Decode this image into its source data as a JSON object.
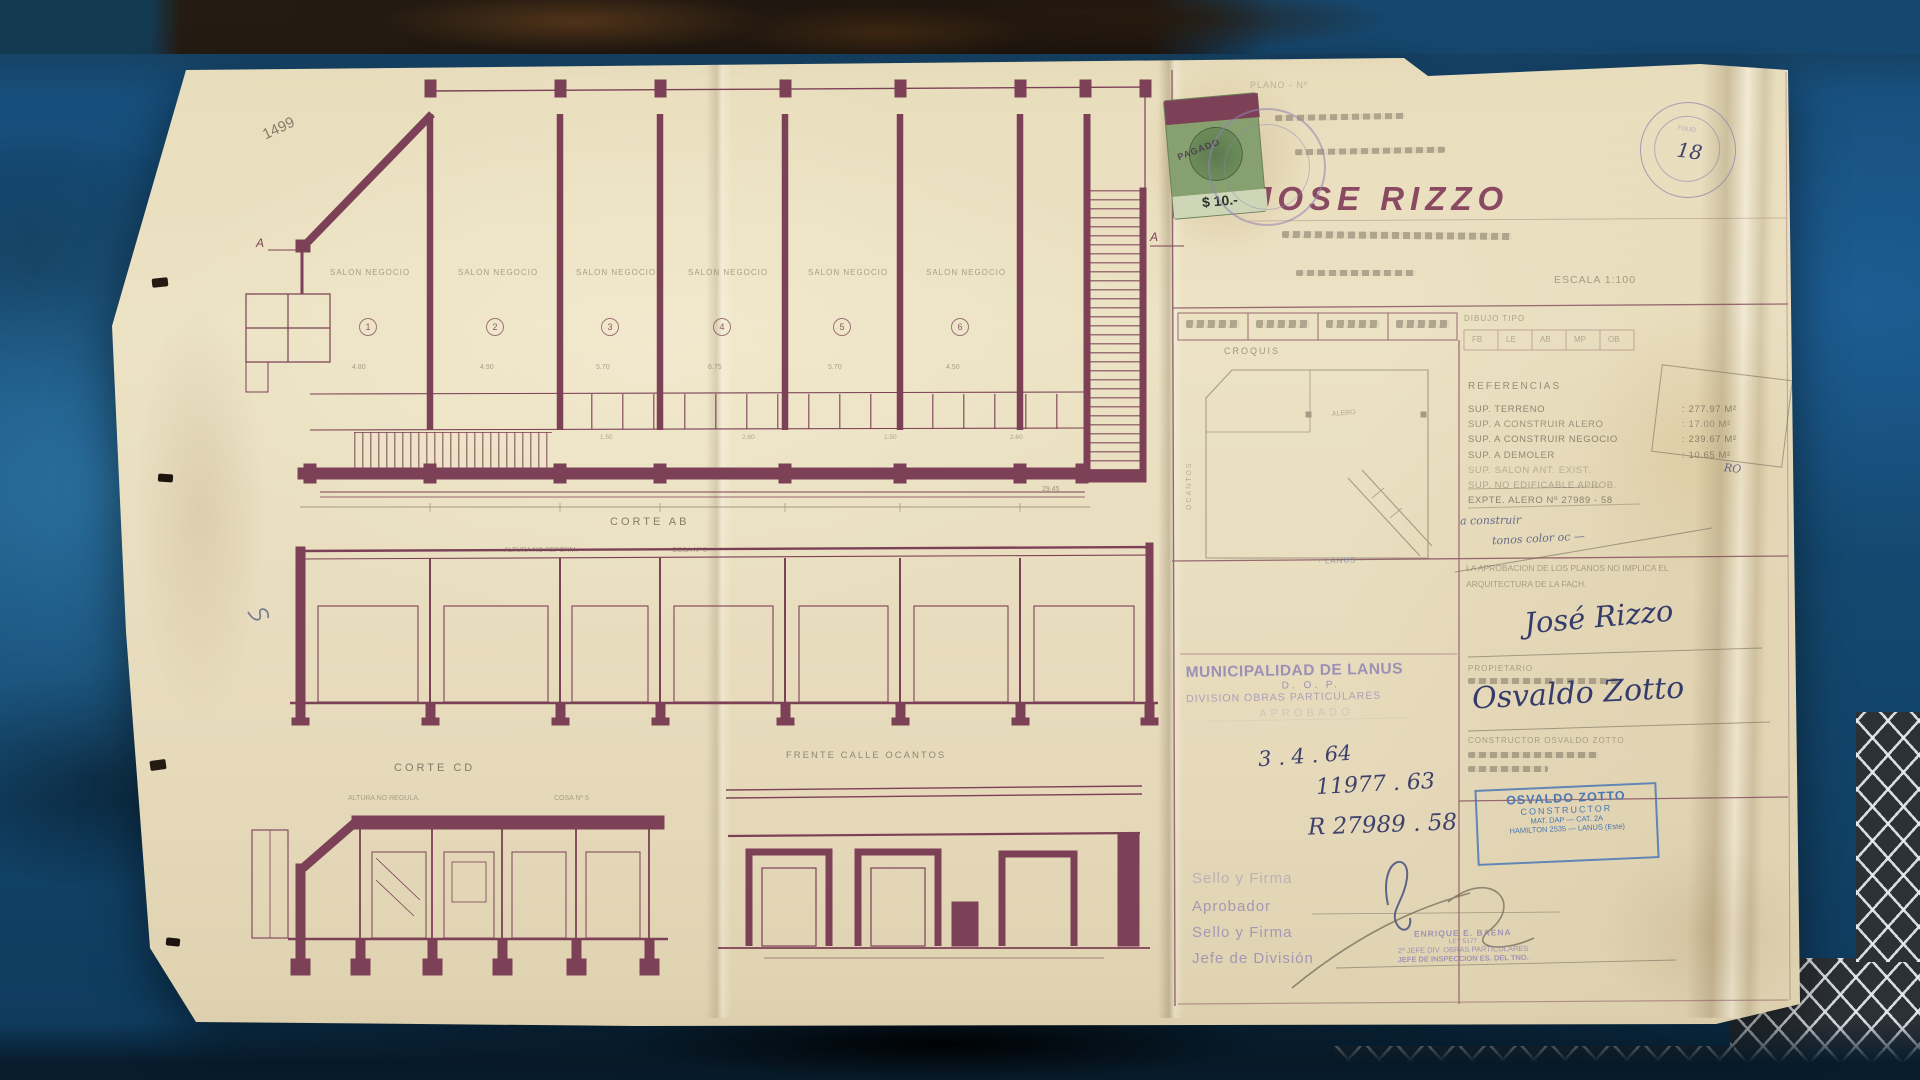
{
  "colors": {
    "paper": "#e9dec0",
    "ink_maroon": "#7c4156",
    "pencil_gray": "#6e6354",
    "stamp_purple": "#8f84b4",
    "stamp_blue": "#4a77b4",
    "ink_blue": "#3c477c",
    "table_blue": "#1b5484",
    "fiscal_green": "#86a070"
  },
  "plan": {
    "sheet_number": "1499",
    "section_marker": "A",
    "salon_label": "SALON NEGOCIO",
    "bay_numbers": [
      "1",
      "2",
      "3",
      "4",
      "5",
      "6"
    ],
    "bay_dims": [
      "4.80",
      "4.90",
      "5.70",
      "6.75",
      "5.70",
      "4.50"
    ],
    "service_dims": [
      "1.50",
      "2.60",
      "1.50",
      "2.60"
    ],
    "total_dim": "29.45",
    "corte_ab_label": "CORTE AB",
    "corte_ab_note_left": "ALTURA NO REFORM.",
    "corte_ab_note_right": "COSA Nº 5",
    "corte_cd_label": "CORTE CD",
    "corte_cd_note_left": "ALTURA NO REGULA.",
    "corte_cd_note_right": "COSA Nº 5",
    "frente_label": "FRENTE CALLE OCANTOS"
  },
  "title_block": {
    "top_pencil_line": "PLANO - Nº",
    "owner_name": "JOSE RIZZO",
    "escala": "ESCALA 1:100",
    "dibujo_tipo_label": "DIBUJO TIPO",
    "dibujo_cells": [
      "FB",
      "LE",
      "AB",
      "MP",
      "OB"
    ],
    "croquis_label": "CROQUIS",
    "croquis_street": "OCANTOS",
    "croquis_alero": "ALERO",
    "croquis_fragment": "· LANUS ·",
    "referencias_title": "REFERENCIAS",
    "ref_rows": [
      {
        "label": "SUP. TERRENO",
        "value": ": 277.97 M²"
      },
      {
        "label": "SUP. A CONSTRUIR ALERO",
        "value": ": 17.00 M²"
      },
      {
        "label": "SUP. A CONSTRUIR NEGOCIO",
        "value": ": 239.67 M²"
      },
      {
        "label": "SUP. A DEMOLER",
        "value": ": 10.65 M²"
      },
      {
        "label": "SUP. SALON ANT. EXIST.",
        "value": ""
      },
      {
        "label": "SUP. NO EDIFICABLE APROB.",
        "value": ""
      },
      {
        "label": "EXPTE. ALERO Nº 27989 - 58",
        "value": ""
      }
    ],
    "blue_note_1": "a construir",
    "blue_note_2": "tonos color  oc —",
    "blue_note_3": "RO",
    "aprobacion_line_1": "LA APROBACION DE LOS PLANOS NO IMPLICA EL",
    "aprobacion_line_2": "ARQUITECTURA DE LA FACH.",
    "owner_signature": "José Rizzo",
    "propietario_label": "PROPIETARIO",
    "builder_signature": "Osvaldo Zotto",
    "constructor_label": "CONSTRUCTOR  OSVALDO ZOTTO",
    "zotto_stamp": {
      "line1": "OSVALDO ZOTTO",
      "line2": "CONSTRUCTOR",
      "line3": "MAT. DAP — CAT. 2A",
      "line4": "HAMILTON 2535 — LANUS (Este)"
    },
    "municipal_stamp": {
      "line1": "MUNICIPALIDAD DE LANUS",
      "line2": "D. O. P.",
      "line3": "DIVISION OBRAS PARTICULARES",
      "line4": "APROBADO"
    },
    "date_1": "3 . 4 . 64",
    "number_1": "11977 . 63",
    "number_2": "R 27989 . 58",
    "footer_labels": [
      "Sello y Firma",
      "Aprobador",
      "Sello y Firma",
      "Jefe de División"
    ],
    "baena_stamp": {
      "line1": "ENRIQUE E. BAENA",
      "line2": "LEY 5177",
      "line3": "2º JEFE DIV. OBRAS PARTICULARES",
      "line4": "JEFE DE INSPECCION ES. DEL TNO."
    },
    "fiscal_value": "$ 10.-",
    "fiscal_overprint": "PAGADO",
    "folio_number": "18",
    "folio_word": "FOLIO"
  }
}
